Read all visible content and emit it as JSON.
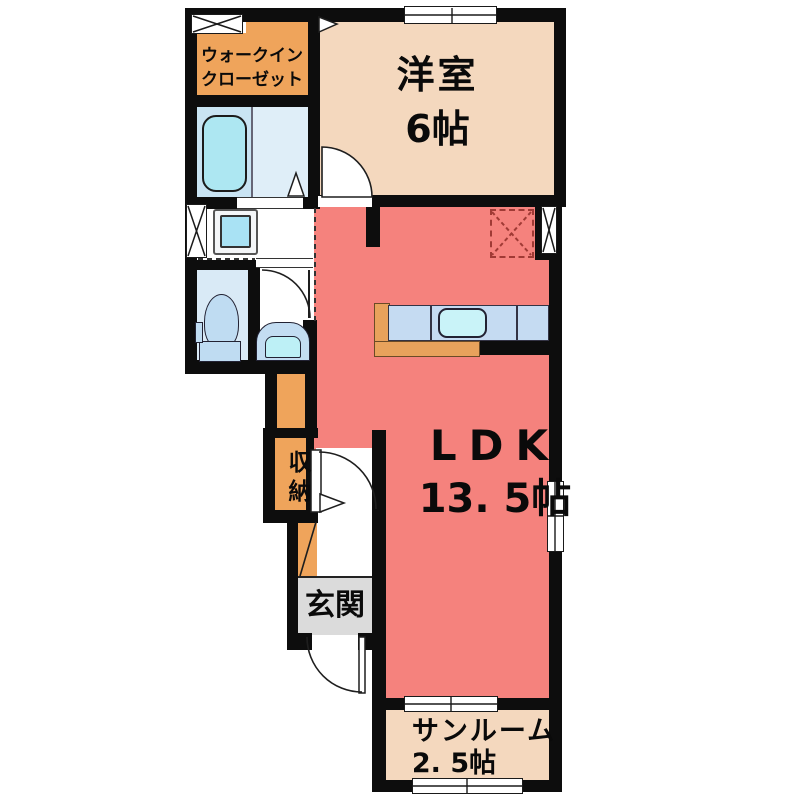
{
  "rooms": {
    "walk_in_closet": {
      "line1": "ウォークイン",
      "line2": "クローゼット"
    },
    "western_room": {
      "name": "洋室",
      "size": "6帖"
    },
    "ldk": {
      "name": "LDK",
      "size": "13. 5帖"
    },
    "storage": {
      "label": "収納"
    },
    "entrance": {
      "label": "玄関"
    },
    "sunroom": {
      "name": "サンルーム",
      "size": "2. 5帖"
    }
  },
  "colors": {
    "wall": "#0d0d0d",
    "ldk_floor": "#F5827D",
    "tatami_room_floor": "#F4D8BE",
    "closet_orange": "#EFA45B",
    "bathroom_blue": "#C9E4F3",
    "washroom_white": "#FFFFFF",
    "toilet_blue": "#D9EAF6",
    "entrance_gray": "#DBDBDB",
    "bathtub_blue": "#ADE7F2",
    "kitchen_counter_blue": "#C5DBF2",
    "sink_cyan": "#C9F3F8",
    "refrigerator_dashed_red": "#A03A35"
  }
}
